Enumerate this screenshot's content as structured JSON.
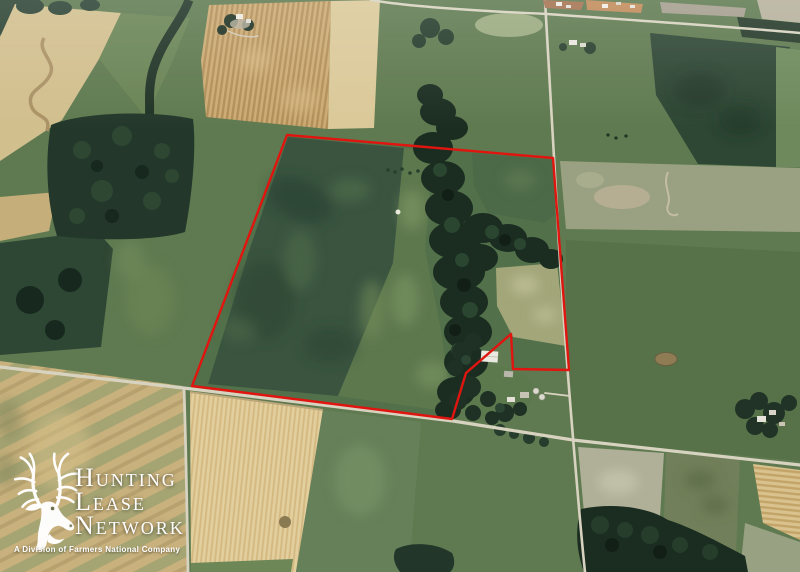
{
  "watermark": {
    "icon": "deer-antlers-icon",
    "brand_lines": [
      "Hunting",
      "Lease",
      "Network"
    ],
    "tagline": "A Division of Farmers National Company",
    "text_color": "#ffffff"
  },
  "overlay": {
    "boundary_color": "#e0150f",
    "boundary_stroke_width": 2.4,
    "boundary_points": [
      [
        287,
        135
      ],
      [
        553,
        158
      ],
      [
        569,
        370
      ],
      [
        513,
        369
      ],
      [
        511,
        334
      ],
      [
        466,
        373
      ],
      [
        452,
        419
      ],
      [
        192,
        386
      ]
    ]
  },
  "scene": {
    "type": "oblique-aerial-farmland-photo",
    "palette": {
      "pasture_green": "#5f7a50",
      "dark_crop_green": "#2e4634",
      "forest_green": "#1b2d21",
      "wheat_tan_bright": "#e3cf9e",
      "stubble_tan": "#c8b17c",
      "plowed_tan_rows": "#cdab74",
      "road_light": "#d8d3c0",
      "bare_gray": "#b3b29c"
    }
  }
}
